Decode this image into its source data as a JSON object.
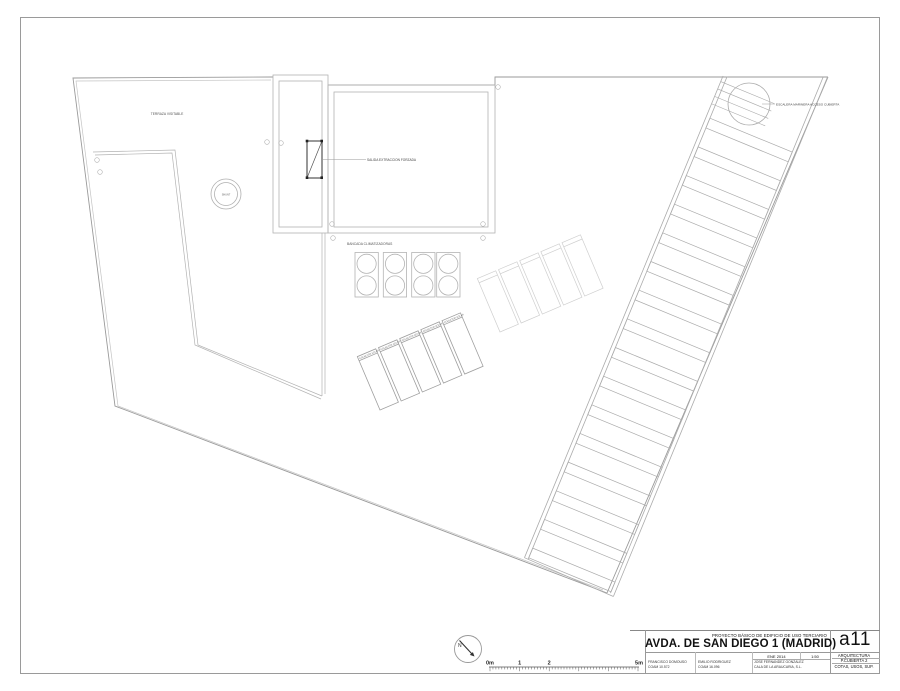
{
  "plan": {
    "labels": {
      "terrace": "TERRAZA VISITABLE",
      "forced_extraction": "SALIDA EXTRACCION FORZADA",
      "vent": "SHUNT",
      "ac_bench": "BANCADA CLIMATIZADORAS",
      "solar_collector": "COLECTOR SOLAR",
      "roof_access_stair": "ESCALERA MARINERA ACCESO CUBIERTA"
    },
    "north_label": "N"
  },
  "scale_bar": {
    "start": "0m",
    "m1": "1",
    "m2": "2",
    "end": "5m"
  },
  "title_block": {
    "project_type": "PROYECTO BÁSICO DE EDIFICIO DE USO TERCIARIO",
    "project_title": "AVDA. DE SAN DIEGO 1 (MADRID)",
    "date": "ENE 2014",
    "scale": "1:50",
    "sheet_code": "a11",
    "discipline": "ARQUITECTURA",
    "sheet_name": "P.CUBIERTA 2",
    "sheet_contents": "COTAS, USOS, SUP.",
    "signatories": [
      {
        "name": "FRANCISCO DOMOUSO",
        "credential": "COAM 10.572"
      },
      {
        "name": "EMILIO RODRIGUEZ",
        "credential": "COAM 16.096"
      },
      {
        "name": "JOSE FERNANDEZ GONZALEZ",
        "credential": "CALA DE LA ARAUCARIA, S.L."
      }
    ]
  },
  "accent_colors": {
    "line": "#b3b3b3",
    "boundary": "#9a9a9a",
    "ink": "#222222"
  }
}
